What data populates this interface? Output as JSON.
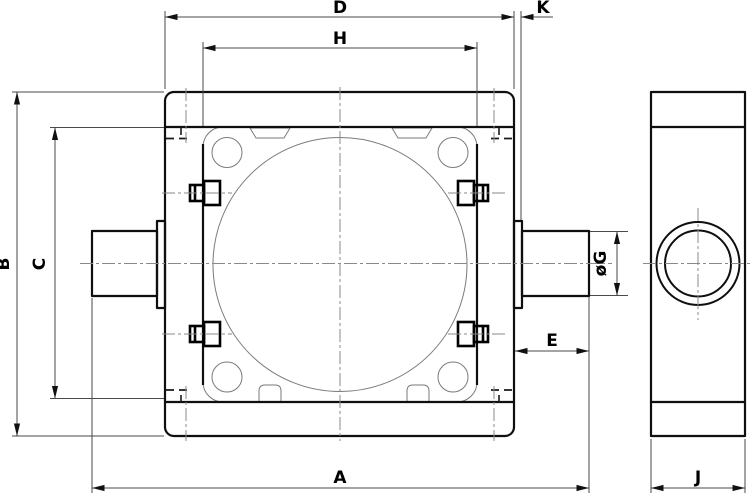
{
  "drawing": {
    "type": "technical-dimension-drawing",
    "views": {
      "front_view": "housing-front-view",
      "side_view": "housing-side-view"
    },
    "dimensions": {
      "a": "A",
      "b": "B",
      "c": "C",
      "d": "D",
      "e": "E",
      "g": "øG",
      "h": "H",
      "j": "J",
      "k": "K"
    },
    "line_colors": {
      "outline": "#0f0f0f",
      "thin_line": "#7a7a7a",
      "dimension_line": "#4a4a4a",
      "centerline": "#8a8a8a"
    }
  }
}
